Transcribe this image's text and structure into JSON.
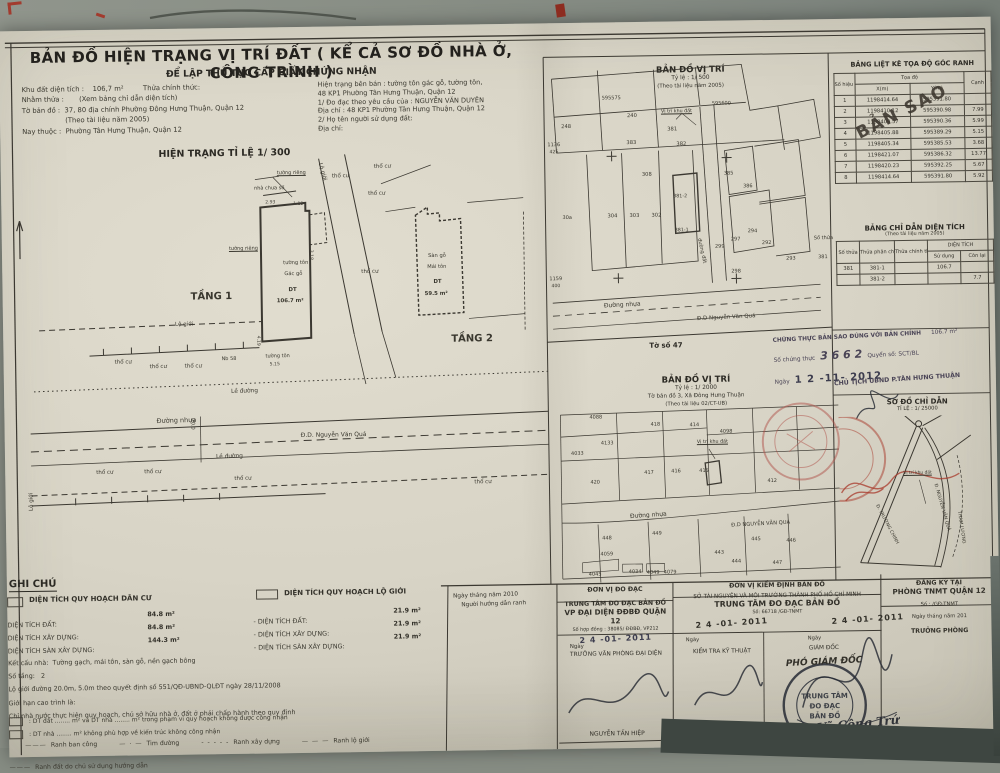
{
  "colors": {
    "photo_background": "#868c83",
    "paper": "#d8d4c6",
    "ink": "#2f2d28",
    "red_stamp": "#a8392b",
    "purple_ink": "#4a4456",
    "date_stamp_ink": "#3c3c4e"
  },
  "header": {
    "title": "BẢN ĐỒ HIỆN TRẠNG VỊ TRÍ ĐẤT ( KỂ CẢ SƠ ĐỒ NHÀ Ở, CÔNG TRÌNH )",
    "subtitle": "ĐỂ LẬP THỦ TỤC CẤP GIẤY CHỨNG NHẬN"
  },
  "info": {
    "left_lines": [
      "Khu đất diện tích :    106,7 m²         Thửa chính thức:",
      "Nhằm thửa :       (Xem bảng chỉ dẫn diện tích)",
      "Tờ bản đồ :  37, 80 địa chính Phường Đông Hưng Thuận, Quận 12",
      "                    (Theo tài liệu năm 2005)",
      "Nay thuộc :  Phường Tân Hưng Thuận, Quận 12"
    ],
    "right_lines": [
      "Hiện trạng bên bán : tường tôn gác gỗ, tường tôn,",
      "48 KP1 Phường Tân Hưng Thuận, Quận 12",
      "1/ Đo đạc theo yêu cầu của : NGUYỄN VĂN DUYÊN",
      "Địa chỉ : 48 KP1 Phường Tân Hưng Thuận, Quận 12",
      "2/ Họ tên người sử dụng đất:",
      "Địa chỉ:"
    ]
  },
  "plan": {
    "title": "HIỆN TRẠNG TỈ LỆ 1/ 300",
    "labels": [
      {
        "t": "thổ cư",
        "x": 363,
        "y": 11
      },
      {
        "t": "thổ cư",
        "x": 321,
        "y": 20
      },
      {
        "t": "thổ cư",
        "x": 357,
        "y": 38
      },
      {
        "t": "thổ cư",
        "x": 349,
        "y": 116
      },
      {
        "t": "thổ cư",
        "x": 101,
        "y": 203
      },
      {
        "t": "thổ cư",
        "x": 136,
        "y": 208
      },
      {
        "t": "thổ cư",
        "x": 171,
        "y": 208
      },
      {
        "t": "thổ cư",
        "x": 81,
        "y": 313
      },
      {
        "t": "thổ cư",
        "x": 129,
        "y": 313
      },
      {
        "t": "thổ cư",
        "x": 219,
        "y": 321
      },
      {
        "t": "thổ cư",
        "x": 459,
        "y": 328
      },
      {
        "t": "Nb 58",
        "x": 208,
        "y": 201,
        "s": 5
      },
      {
        "t": "tường tôn",
        "x": 252,
        "y": 199,
        "s": 5
      },
      {
        "t": "tường tôn",
        "x": 271,
        "y": 106,
        "s": 5.2
      },
      {
        "t": "Gác gỗ",
        "x": 272,
        "y": 117,
        "s": 5.2
      },
      {
        "t": "DT",
        "x": 276,
        "y": 133,
        "s": 5.4,
        "c": "b"
      },
      {
        "t": "106.7 m²",
        "x": 264,
        "y": 144,
        "s": 5.4,
        "c": "b"
      },
      {
        "t": "tường riêng",
        "x": 266,
        "y": 16,
        "s": 5,
        "c": "u"
      },
      {
        "t": "tường riêng",
        "x": 217,
        "y": 91,
        "s": 5,
        "c": "u"
      },
      {
        "t": "nhà chưa số",
        "x": 243,
        "y": 31,
        "s": 5
      },
      {
        "t": "TẦNG 1",
        "x": 178,
        "y": 136,
        "s": 10,
        "c": "b",
        "n": "floor-1-label"
      },
      {
        "t": "TẦNG 2",
        "x": 438,
        "y": 182,
        "s": 10,
        "c": "b",
        "n": "floor-2-label"
      },
      {
        "t": "Sàn gỗ",
        "x": 416,
        "y": 101,
        "s": 5.2
      },
      {
        "t": "Mái tôn",
        "x": 415,
        "y": 112,
        "s": 5.2
      },
      {
        "t": "DT",
        "x": 421,
        "y": 127,
        "s": 5.4,
        "c": "b"
      },
      {
        "t": "59.5 m²",
        "x": 412,
        "y": 139,
        "s": 5.4,
        "c": "b"
      },
      {
        "t": "Lộ giới",
        "x": 162,
        "y": 166
      },
      {
        "t": "Lộ giới",
        "x": 311,
        "y": 8,
        "r": 75
      },
      {
        "t": "Lộ giới",
        "x": 14,
        "y": 352,
        "r": -90
      },
      {
        "t": "Lề đường",
        "x": 217,
        "y": 234,
        "s": 5.8,
        "r": -1
      },
      {
        "t": "Lề đường",
        "x": 201,
        "y": 299,
        "s": 5.8,
        "r": -1
      },
      {
        "t": "Đường nhựa",
        "x": 142,
        "y": 261,
        "s": 6.5,
        "r": -1
      },
      {
        "t": "Đ.D. Nguyễn Văn Quá",
        "x": 286,
        "y": 278,
        "s": 6
      },
      {
        "t": "20.0",
        "x": 180,
        "y": 262,
        "s": 5,
        "r": 90
      },
      {
        "t": "2.93",
        "x": 254,
        "y": 46,
        "s": 4.6,
        "c": "dim"
      },
      {
        "t": "1.12",
        "x": 282,
        "y": 48,
        "s": 4.6,
        "c": "dim"
      },
      {
        "t": "5.15",
        "x": 256,
        "y": 208,
        "s": 4.6,
        "c": "dim"
      },
      {
        "t": "4.19",
        "x": 246,
        "y": 180,
        "s": 4.6,
        "r": 90,
        "c": "dim"
      },
      {
        "t": "3.18",
        "x": 300,
        "y": 95,
        "s": 4.6,
        "r": 90,
        "c": "dim"
      }
    ]
  },
  "map500": {
    "title1": "BẢN ĐỒ VỊ TRÍ",
    "title2": "Tỷ lệ :  1/ 500",
    "title3": "(Theo tài liệu năm 2005)",
    "sheet_note": "Tờ số 47",
    "labels": [
      {
        "t": "595575",
        "x": 56,
        "y": 40,
        "s": 5
      },
      {
        "t": "595600",
        "x": 166,
        "y": 47,
        "s": 5
      },
      {
        "t": "1136",
        "x": 1,
        "y": 86,
        "s": 5
      },
      {
        "t": "425",
        "x": 3,
        "y": 94,
        "s": 4.6
      },
      {
        "t": "1159",
        "x": 1,
        "y": 220,
        "s": 5
      },
      {
        "t": "400",
        "x": 3,
        "y": 228,
        "s": 4.6
      },
      {
        "t": "248",
        "x": 15,
        "y": 68,
        "s": 5.2
      },
      {
        "t": "240",
        "x": 81,
        "y": 58,
        "s": 5.2
      },
      {
        "t": "381",
        "x": 121,
        "y": 72,
        "s": 5.2
      },
      {
        "t": "383",
        "x": 80,
        "y": 85,
        "s": 5.2
      },
      {
        "t": "382",
        "x": 130,
        "y": 87,
        "s": 5.2
      },
      {
        "t": "308",
        "x": 95,
        "y": 117,
        "s": 5.2
      },
      {
        "t": "304",
        "x": 60,
        "y": 158,
        "s": 5.2
      },
      {
        "t": "303",
        "x": 82,
        "y": 158,
        "s": 5.2
      },
      {
        "t": "302",
        "x": 104,
        "y": 158,
        "s": 5.2
      },
      {
        "t": "381-2",
        "x": 126,
        "y": 140,
        "s": 4.8
      },
      {
        "t": "381-1",
        "x": 127,
        "y": 174,
        "s": 4.8
      },
      {
        "t": "385",
        "x": 177,
        "y": 117,
        "s": 5
      },
      {
        "t": "386",
        "x": 196,
        "y": 130,
        "s": 5
      },
      {
        "t": "299",
        "x": 167,
        "y": 190,
        "s": 5
      },
      {
        "t": "297",
        "x": 183,
        "y": 183,
        "s": 5
      },
      {
        "t": "294",
        "x": 200,
        "y": 175,
        "s": 5
      },
      {
        "t": "298",
        "x": 183,
        "y": 215,
        "s": 5
      },
      {
        "t": "292",
        "x": 214,
        "y": 187,
        "s": 5
      },
      {
        "t": "293",
        "x": 238,
        "y": 203,
        "s": 5
      },
      {
        "t": "30a",
        "x": 15,
        "y": 159,
        "s": 5
      },
      {
        "t": "Vị trí khu đất",
        "x": 115,
        "y": 55,
        "s": 4.8,
        "c": "u"
      },
      {
        "t": "đường đất",
        "x": 153,
        "y": 183,
        "s": 5,
        "r": 78
      },
      {
        "t": "Đường nhựa",
        "x": 55,
        "y": 247,
        "s": 6,
        "r": -2
      },
      {
        "t": "Đ.D Nguyễn Văn Quá",
        "x": 148,
        "y": 262,
        "s": 5.5,
        "r": -2
      },
      {
        "t": "Số thửa",
        "x": 266,
        "y": 183,
        "s": 5
      },
      {
        "t": "381",
        "x": 270,
        "y": 202,
        "s": 5
      }
    ]
  },
  "map2000": {
    "title1": "BẢN ĐỒ VỊ TRÍ",
    "title2": "Tỷ lệ :  1/ 2000",
    "title3": "Tờ bản đồ  3, Xã Đông Hưng Thuận",
    "title4": "(Theo tài liệu 02/CT-UB)",
    "labels": [
      {
        "t": "4088",
        "x": 33,
        "y": 43,
        "s": 5
      },
      {
        "t": "418",
        "x": 94,
        "y": 51,
        "s": 5
      },
      {
        "t": "414",
        "x": 133,
        "y": 52,
        "s": 5
      },
      {
        "t": "4098",
        "x": 163,
        "y": 59,
        "s": 5
      },
      {
        "t": "4133",
        "x": 44,
        "y": 69,
        "s": 5
      },
      {
        "t": "4033",
        "x": 14,
        "y": 79,
        "s": 5
      },
      {
        "t": "417",
        "x": 87,
        "y": 99,
        "s": 5
      },
      {
        "t": "416",
        "x": 114,
        "y": 98,
        "s": 5
      },
      {
        "t": "415",
        "x": 142,
        "y": 98,
        "s": 5
      },
      {
        "t": "420",
        "x": 33,
        "y": 108,
        "s": 5
      },
      {
        "t": "412",
        "x": 210,
        "y": 109,
        "s": 5
      },
      {
        "t": "448",
        "x": 44,
        "y": 164,
        "s": 5
      },
      {
        "t": "449",
        "x": 94,
        "y": 160,
        "s": 5
      },
      {
        "t": "445",
        "x": 193,
        "y": 167,
        "s": 5
      },
      {
        "t": "446",
        "x": 228,
        "y": 169,
        "s": 5
      },
      {
        "t": "443",
        "x": 156,
        "y": 180,
        "s": 5
      },
      {
        "t": "444",
        "x": 173,
        "y": 189,
        "s": 5
      },
      {
        "t": "447",
        "x": 214,
        "y": 191,
        "s": 5
      },
      {
        "t": "4059",
        "x": 42,
        "y": 180,
        "s": 5
      },
      {
        "t": "4045",
        "x": 30,
        "y": 200,
        "s": 5
      },
      {
        "t": "4034",
        "x": 70,
        "y": 198,
        "s": 5
      },
      {
        "t": "4049",
        "x": 88,
        "y": 199,
        "s": 5
      },
      {
        "t": "4079",
        "x": 105,
        "y": 199,
        "s": 5
      },
      {
        "t": "Vị trí khu đất",
        "x": 140,
        "y": 70,
        "s": 4.8,
        "c": "u"
      },
      {
        "t": "Đường nhựa",
        "x": 72,
        "y": 142,
        "s": 6,
        "r": -3
      },
      {
        "t": "Đ.D NGUYỄN VĂN QUÁ",
        "x": 173,
        "y": 153,
        "s": 5.2,
        "r": -2
      }
    ]
  },
  "coord_table": {
    "title": "BẢNG LIỆT KÊ TỌA ĐỘ GÓC RANH",
    "h_point": "Số hiệu điểm",
    "h_coord": "Tọa độ",
    "h_x": "X(m)",
    "h_y": "Y(m)",
    "h_edge": "Cạnh",
    "stamp": "BẢN SAO",
    "rows": [
      [
        "1",
        "1198414.64",
        "595391.80",
        ""
      ],
      [
        "2",
        "1198410.12",
        "595390.98",
        "7.99"
      ],
      [
        "3",
        "1198409.57",
        "595390.36",
        "5.99"
      ],
      [
        "4",
        "1198405.88",
        "595389.29",
        "5.15"
      ],
      [
        "5",
        "1198405.34",
        "595385.53",
        "3.68"
      ],
      [
        "6",
        "1198421.07",
        "595386.32",
        "13.77"
      ],
      [
        "7",
        "1198420.23",
        "595392.25",
        "5.67"
      ],
      [
        "8",
        "1198414.64",
        "595391.80",
        "5.92"
      ]
    ]
  },
  "area_table": {
    "title": "BẢNG CHỈ DẪN DIỆN TÍCH",
    "subtitle": "(Theo tài liệu năm 2005)",
    "h_plot": "Số thửa",
    "h_sub": "Thửa phân chiết",
    "h_official": "Thửa chính thức",
    "h_area": "DIỆN TÍCH",
    "h_use": "Sử dụng",
    "h_remain": "Còn lại",
    "rows": [
      [
        "381",
        "381-1",
        "",
        "106.7",
        ""
      ],
      [
        "",
        "381-2",
        "",
        "",
        "7.7"
      ]
    ]
  },
  "certify": {
    "l1": "CHỨNG THỰC BẢN SAO ĐÚNG VỚI BẢN CHÍNH",
    "area": "106.7 m²",
    "pre": "Số chứng thực",
    "num": "3 6 6 2",
    "post": "Quyển số:       SCT/BL",
    "ngay": "Ngày",
    "date": "1 2  -11-  2012",
    "chairman": "CHỦ TỊCH UBND P.TÂN HƯNG THUẬN"
  },
  "sodo": {
    "title": "SƠ ĐỒ CHỈ DẪN",
    "scale": "TỈ LỆ : 1/ 25000",
    "labels": [
      {
        "t": "Đ. NGUYỄN VĂN QUÁ",
        "x": 97,
        "y": 90,
        "r": 75,
        "s": 4.6
      },
      {
        "t": "Đ. TRƯỜNG CHINH",
        "x": 38,
        "y": 110,
        "r": 63,
        "s": 4.6
      },
      {
        "t": "THAM LƯƠNG",
        "x": 120,
        "y": 118,
        "r": 82,
        "s": 4.6
      },
      {
        "t": "Vị trí khu đất",
        "x": 64,
        "y": 78,
        "s": 4.4,
        "c": "u"
      }
    ]
  },
  "ghichu": {
    "heading": "GHI CHÚ",
    "legend1": "DIỆN TÍCH QUY HOẠCH DÂN CƯ",
    "legend2": "DIỆN TÍCH QUY HOẠCH LỘ GIỚI",
    "items1": [
      [
        "DIỆN TÍCH ĐẤT:",
        "84.8 m²"
      ],
      [
        "DIỆN TÍCH XÂY DỰNG:",
        "84.8 m²"
      ],
      [
        "DIỆN TÍCH SÀN XÂY DỰNG:",
        "144.3 m²"
      ]
    ],
    "items2": [
      [
        "- DIỆN TÍCH ĐẤT:",
        "21.9 m²"
      ],
      [
        "- DIỆN TÍCH XÂY DỰNG:",
        "21.9 m²"
      ],
      [
        "- DIỆN TÍCH SÀN XÂY DỰNG:",
        "21.9 m²"
      ]
    ],
    "notes": [
      "Kết cấu nhà:  Tường gạch, mái tôn, sàn gỗ, nền gạch bông",
      "Số tầng:   2",
      "Lộ giới đường 20.0m, 5.0m theo quyết định số 551/QĐ-UBND-QLĐT ngày 28/11/2008",
      "Giới hạn cao trình là:",
      "Chỉ nhà nước thực hiện quy hoạch, chủ sở hữu nhà ở, đất ở phải chấp hành theo quy định"
    ],
    "cb1": ": DT đất ........ m² và DT nhà ........ m² trong phạm vi quy hoạch không được công nhận",
    "cb2": ": DT nhà ........ m² không phù hợp về kiến trúc không công nhận",
    "symbols": [
      {
        "g": "———",
        "t": "Ranh ban công"
      },
      {
        "g": "— · —",
        "t": "Tim đường"
      },
      {
        "g": "- - - - -",
        "t": "Ranh xây dựng"
      },
      {
        "g": "— — —",
        "t": "Ranh lộ giới"
      }
    ],
    "symbols_last": [
      {
        "g": "———",
        "t": "Ranh đất do chủ sử dụng hướng dẫn"
      }
    ]
  },
  "signoff": {
    "guide": {
      "date_line": "Ngày          tháng          năm 2010",
      "role": "Người hướng dẫn ranh"
    },
    "dodac": {
      "header": "ĐƠN VỊ ĐO ĐẠC",
      "org1": "TRUNG TÂM ĐO ĐẠC BẢN ĐỒ",
      "org2": "VP ĐẠI DIỆN ĐĐBĐ QUẬN 12",
      "contract": "Số hợp đồng : 38085/ ĐĐBĐ, VP212",
      "ngay": "Ngày",
      "date_stamp": "2 4  -01-  2011",
      "role": "TRƯỞNG VĂN PHÒNG ĐẠI DIỆN",
      "name": "NGUYỄN TẤN HIỆP"
    },
    "kiemdinh": {
      "header": "ĐƠN VỊ KIỂM ĐỊNH BẢN ĐỒ",
      "org1": "SỞ TÀI NGUYÊN VÀ MÔI TRƯỜNG THÀNH PHỐ HỒ CHÍ MINH",
      "org2": "TRUNG TÂM ĐO ĐẠC BẢN ĐỒ",
      "so": "Số:  66718          /GĐ-TNMT",
      "ngay1": "Ngày",
      "ngay2": "Ngày",
      "date_stamp1": "2 4  -01-  2011",
      "date_stamp2": "2 4  -01-  2011",
      "role1": "KIỂM TRA KỸ THUẬT",
      "role2": "GIÁM ĐỐC",
      "deputy": "PHÓ GIÁM ĐỐC",
      "name1": "Nguyễn Văn Khuê",
      "name2": "Võ Công Trứ",
      "stamp_lines": [
        "TRUNG TÂM",
        "ĐO ĐẠC",
        "BẢN ĐỒ"
      ]
    },
    "dangky": {
      "header1": "ĐĂNG KÝ TẠI",
      "header2": "PHÒNG TNMT QUẬN 12",
      "so": "Số :               /GĐ-TNMT",
      "date_line": "Ngày        tháng        năm 201",
      "role": "TRƯỞNG PHÒNG"
    }
  }
}
